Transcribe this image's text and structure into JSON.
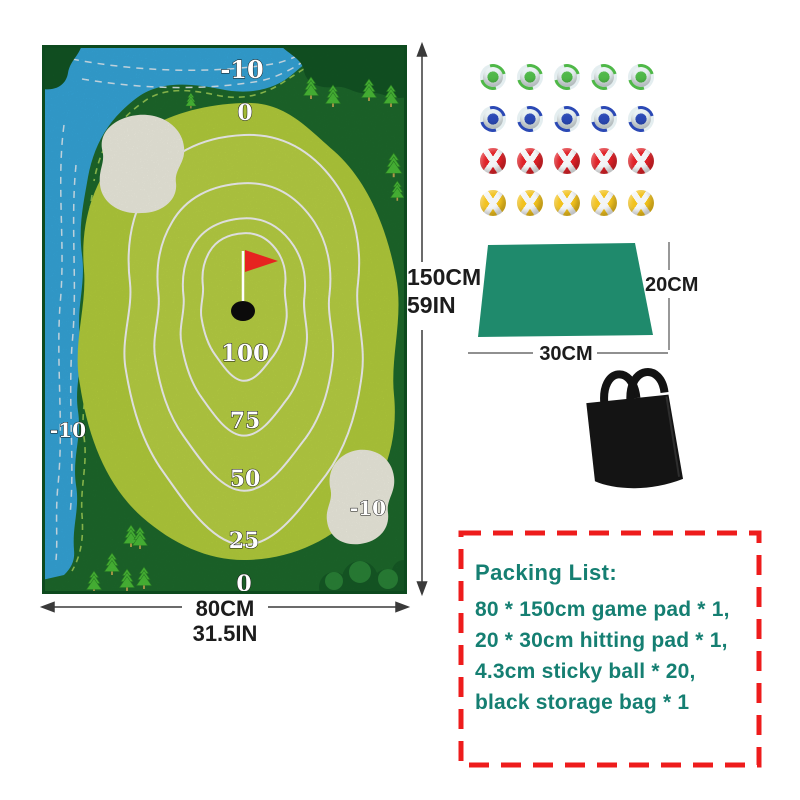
{
  "mat": {
    "labels": {
      "water_top": "-10",
      "zero_top": "0",
      "d100": "100",
      "d75": "75",
      "d50": "50",
      "d25": "25",
      "zero_bottom": "0",
      "bunker_right": "-10",
      "water_left": "-10"
    },
    "colors": {
      "water": "#38aee4",
      "rough": "#1f6e2e",
      "green": "#bcd83f",
      "bunker": "#fbfaec",
      "flag": "#e62320",
      "hole": "#0b0b0b"
    }
  },
  "dimensions": {
    "mat_height_cm": "150CM",
    "mat_height_in": "59IN",
    "mat_width_cm": "80CM",
    "mat_width_in": "31.5IN",
    "pad_depth": "20CM",
    "pad_width": "30CM"
  },
  "balls": {
    "rows": [
      {
        "color_name": "green",
        "hex": "#4fb848",
        "pattern": "triangle-stripe",
        "count": 5
      },
      {
        "color_name": "blue",
        "hex": "#2b49b5",
        "pattern": "triangle-stripe",
        "count": 5
      },
      {
        "color_name": "red",
        "hex": "#e02127",
        "pattern": "cross-stripe",
        "count": 5
      },
      {
        "color_name": "yellow",
        "hex": "#f2c21d",
        "pattern": "cross-stripe",
        "count": 5
      }
    ]
  },
  "hitting_pad": {
    "color": "#1f8a6c"
  },
  "storage_bag": {
    "color": "#141414"
  },
  "packing_list": {
    "title": "Packing List:",
    "items": [
      "80 * 150cm game pad * 1,",
      "20 * 30cm hitting pad * 1,",
      "4.3cm sticky ball * 20,",
      "black storage bag * 1"
    ],
    "text_color": "#157f72",
    "border_color": "#ee1c1c"
  }
}
